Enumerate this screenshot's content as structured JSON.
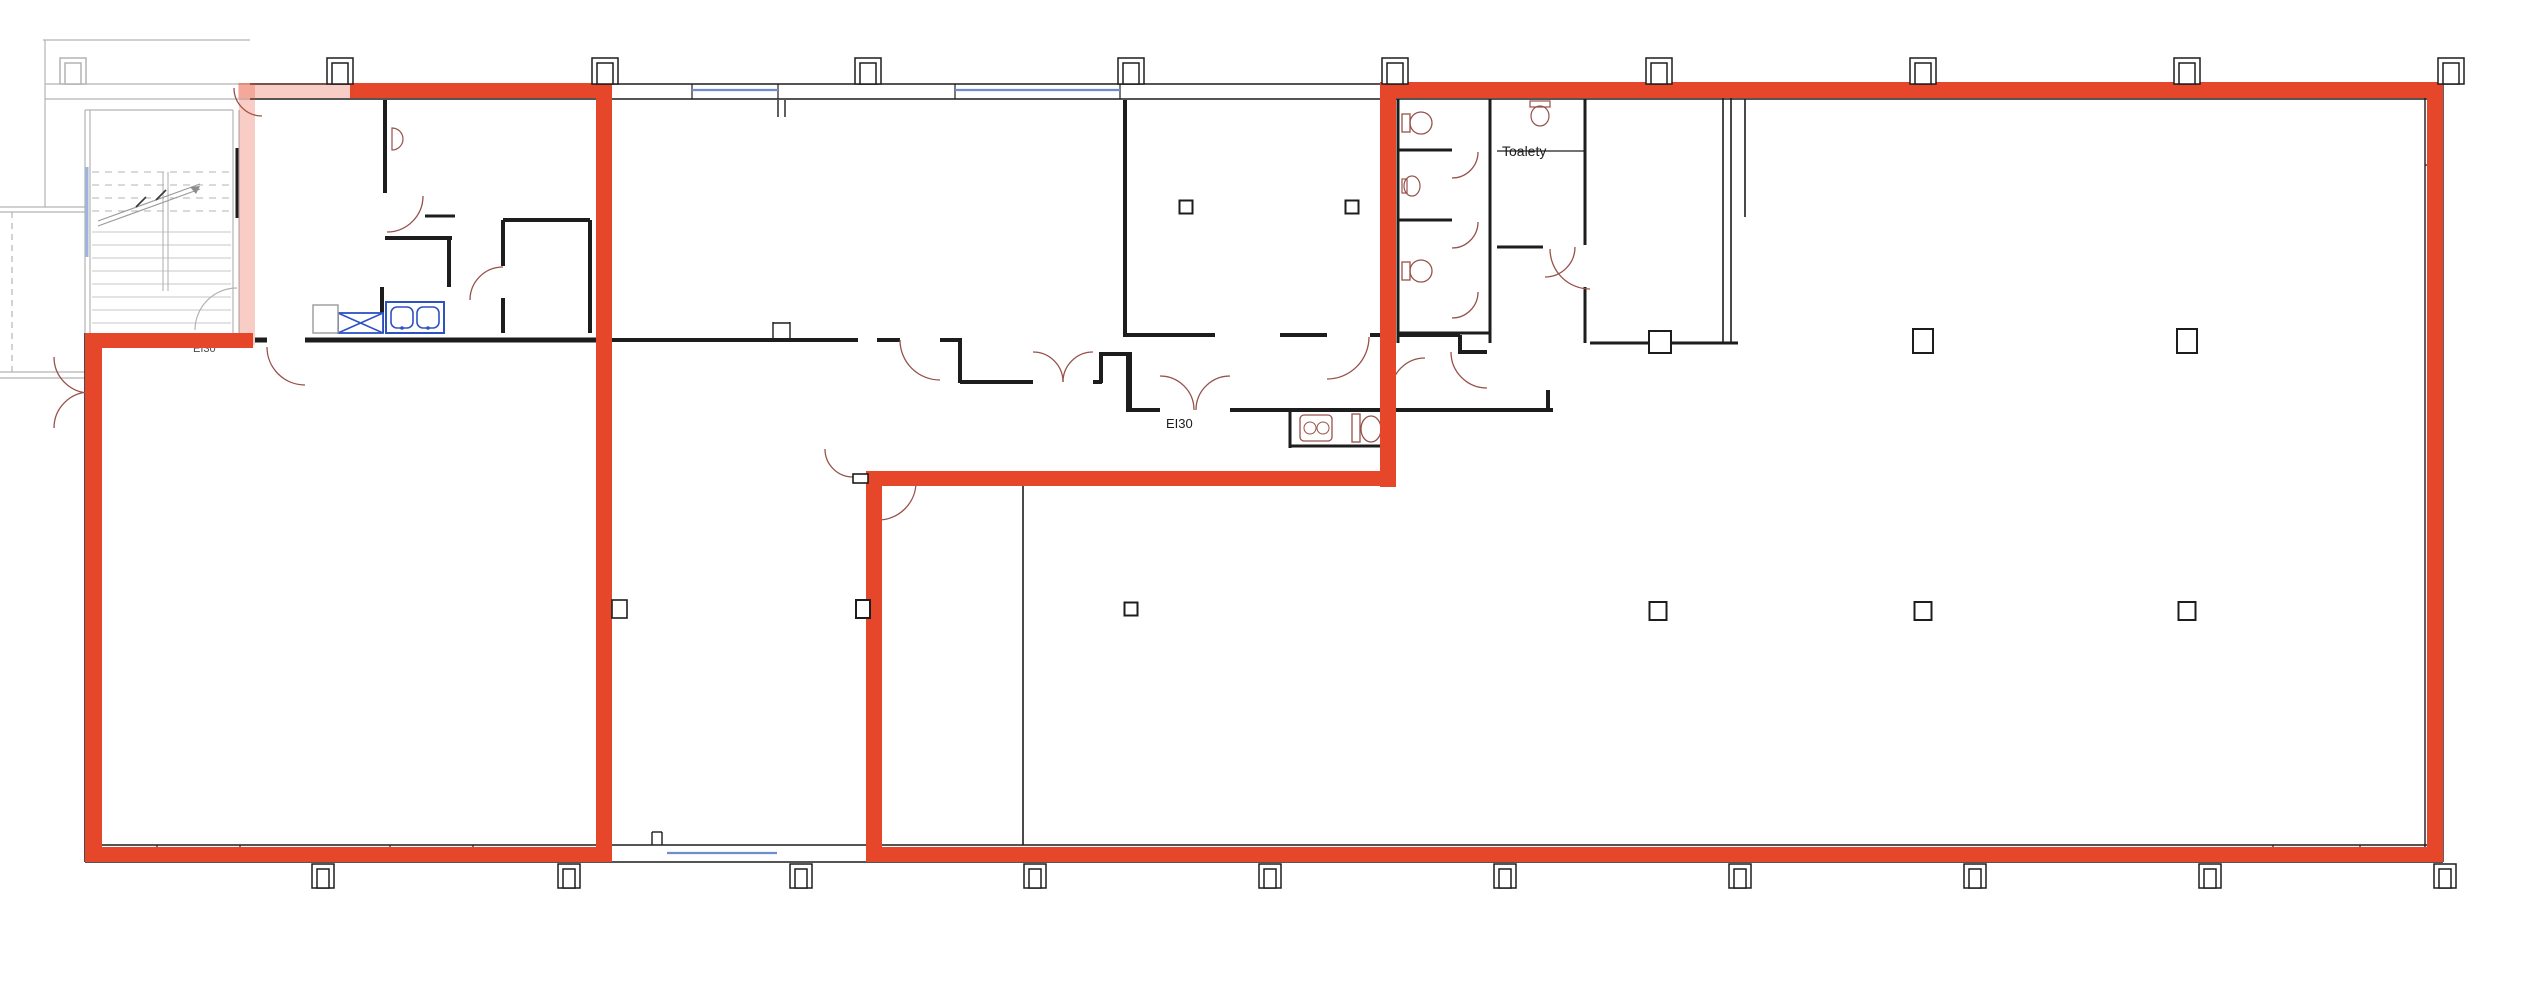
{
  "meta": {
    "title": "Building floor plan with highlighted lease areas",
    "canvas": {
      "width": 2541,
      "height": 994
    },
    "colors": {
      "background": "#ffffff",
      "wall_black": "#1d1d1d",
      "plan_gray": "#b3b3b3",
      "highlight_red": "#e64629",
      "highlight_red_faded": "rgba(230,70,41,0.27)",
      "door_arc_brown": "#96524a",
      "fixture_blue": "#2f52c3",
      "window_light_blue": "#9db4e0",
      "label_dark": "#2e2e2e"
    }
  },
  "labels": [
    {
      "id": "ei30-left-label",
      "text": "EI30",
      "x": 193,
      "y": 352,
      "size": 11,
      "color": "#4a4a4a",
      "under_red": true
    },
    {
      "id": "ei30-middle-label",
      "text": "EI30",
      "x": 1166,
      "y": 428,
      "size": 13,
      "color": "#1d1d1d",
      "under_red": false
    },
    {
      "id": "toalety-label",
      "text": "Toalety",
      "x": 1502,
      "y": 156,
      "size": 14,
      "color": "#1d1d1d",
      "under_red": false
    }
  ],
  "red_outline": {
    "solid": [
      [
        350,
        83,
        262,
        15
      ],
      [
        596,
        83,
        16,
        779
      ],
      [
        85,
        847,
        527,
        15
      ],
      [
        85,
        333,
        17,
        529
      ],
      [
        85,
        333,
        168,
        15
      ],
      [
        1380,
        82,
        1063,
        16
      ],
      [
        1380,
        82,
        16,
        405
      ],
      [
        866,
        471,
        530,
        15
      ],
      [
        866,
        471,
        16,
        391
      ],
      [
        866,
        847,
        1577,
        15
      ],
      [
        2427,
        82,
        16,
        780
      ]
    ],
    "faded": [
      [
        238,
        83,
        116,
        15
      ],
      [
        239,
        83,
        16,
        262
      ]
    ]
  },
  "walls_black": [
    [
      250,
      84,
      2443,
      84,
      1.4
    ],
    [
      250,
      99,
      2443,
      99,
      1.4
    ],
    [
      2425,
      84,
      2425,
      862,
      1.4
    ],
    [
      2443,
      84,
      2443,
      862,
      1.4
    ],
    [
      85,
      845,
      2443,
      845,
      1.4
    ],
    [
      85,
      862,
      2443,
      862,
      1.4
    ],
    [
      85,
      333,
      85,
      862,
      1.6
    ],
    [
      612,
      340,
      858,
      340,
      4
    ],
    [
      877,
      340,
      900,
      340,
      4
    ],
    [
      940,
      340,
      962,
      340,
      4
    ],
    [
      960,
      342,
      960,
      383,
      4
    ],
    [
      960,
      382,
      1033,
      382,
      4
    ],
    [
      1093,
      382,
      1102,
      382,
      4
    ],
    [
      1101,
      352,
      1101,
      383,
      4
    ],
    [
      1101,
      354,
      1127,
      354,
      4
    ],
    [
      1129,
      352,
      1129,
      412,
      6
    ],
    [
      1129,
      410,
      1160,
      410,
      4
    ],
    [
      1230,
      410,
      1553,
      410,
      4
    ],
    [
      1125,
      100,
      1125,
      337,
      4
    ],
    [
      1125,
      335,
      1215,
      335,
      4
    ],
    [
      1280,
      335,
      1327,
      335,
      4
    ],
    [
      1370,
      335,
      1394,
      335,
      4
    ],
    [
      1398,
      335,
      1460,
      335,
      4
    ],
    [
      1460,
      335,
      1460,
      354,
      4
    ],
    [
      1460,
      352,
      1487,
      352,
      4
    ],
    [
      1548,
      390,
      1548,
      412,
      4
    ],
    [
      1290,
      412,
      1290,
      448,
      3
    ],
    [
      1290,
      446,
      1392,
      446,
      3
    ],
    [
      1023,
      486,
      1023,
      845,
      1.6
    ],
    [
      503,
      220,
      503,
      266,
      4
    ],
    [
      503,
      298,
      503,
      333,
      4
    ],
    [
      503,
      220,
      590,
      220,
      4
    ],
    [
      590,
      220,
      590,
      333,
      4
    ],
    [
      305,
      340,
      612,
      340,
      5
    ],
    [
      255,
      340,
      267,
      340,
      5
    ],
    [
      385,
      238,
      452,
      238,
      4
    ],
    [
      449,
      240,
      449,
      287,
      4
    ],
    [
      382,
      287,
      382,
      333,
      4
    ],
    [
      425,
      216,
      455,
      216,
      3
    ],
    [
      385,
      100,
      385,
      193,
      4
    ],
    [
      778,
      100,
      778,
      117,
      1.4
    ],
    [
      785,
      100,
      785,
      117,
      1.4
    ],
    [
      1398,
      99,
      1398,
      343,
      3
    ],
    [
      1490,
      99,
      1490,
      343,
      3
    ],
    [
      1398,
      150,
      1452,
      150,
      3
    ],
    [
      1398,
      220,
      1452,
      220,
      3
    ],
    [
      1398,
      333,
      1490,
      333,
      3
    ],
    [
      1497,
      151,
      1585,
      151,
      1.2
    ],
    [
      1497,
      247,
      1543,
      247,
      3
    ],
    [
      1585,
      99,
      1585,
      245,
      3
    ],
    [
      1585,
      287,
      1585,
      343,
      3
    ],
    [
      1590,
      343,
      1649,
      343,
      3
    ],
    [
      1671,
      343,
      1738,
      343,
      3
    ],
    [
      1723,
      95,
      1723,
      343,
      1.6
    ],
    [
      1731,
      95,
      1731,
      343,
      1.6
    ],
    [
      1745,
      99,
      1745,
      217,
      1.6
    ],
    [
      237,
      148,
      237,
      218,
      3
    ],
    [
      2425,
      165,
      2443,
      165,
      1.2
    ],
    [
      157,
      845,
      157,
      862,
      1.2
    ],
    [
      240,
      845,
      240,
      862,
      1.2
    ],
    [
      390,
      845,
      390,
      862,
      1.2
    ],
    [
      473,
      845,
      473,
      862,
      1.2
    ],
    [
      2273,
      845,
      2273,
      862,
      1.2
    ],
    [
      2360,
      845,
      2360,
      862,
      1.2
    ],
    [
      692,
      84,
      692,
      99,
      1.2
    ],
    [
      778,
      84,
      778,
      99,
      1.2
    ],
    [
      955,
      84,
      955,
      99,
      1.2
    ],
    [
      1120,
      84,
      1120,
      99,
      1.2
    ],
    [
      773,
      322,
      773,
      338,
      1.4
    ],
    [
      790,
      322,
      790,
      338,
      1.4
    ],
    [
      773,
      323,
      790,
      323,
      1.4
    ],
    [
      652,
      832,
      652,
      845,
      1.4
    ],
    [
      662,
      832,
      662,
      845,
      1.4
    ],
    [
      652,
      832,
      662,
      832,
      1.4
    ]
  ],
  "walls_gray": [
    [
      45,
      40,
      45,
      207,
      1.2
    ],
    [
      43,
      40,
      250,
      40,
      1.2
    ],
    [
      45,
      84,
      255,
      84,
      1.2
    ],
    [
      45,
      99,
      255,
      99,
      1.2
    ],
    [
      85,
      110,
      233,
      110,
      1.2
    ],
    [
      85,
      110,
      85,
      333,
      1.2
    ],
    [
      90,
      110,
      90,
      333,
      1.2
    ],
    [
      233,
      110,
      233,
      333,
      1.2
    ],
    [
      239,
      110,
      239,
      333,
      1.2
    ],
    [
      0,
      207,
      85,
      207,
      1.2
    ],
    [
      0,
      212,
      85,
      212,
      1.2
    ],
    [
      0,
      372,
      85,
      372,
      1.2
    ],
    [
      0,
      378,
      85,
      378,
      1.2
    ]
  ],
  "walls_gray_dashed": [
    [
      12,
      212,
      12,
      372,
      1.2
    ]
  ],
  "windows_blue": [
    [
      692,
      90,
      778,
      90
    ],
    [
      955,
      90,
      1120,
      90
    ],
    [
      667,
      853,
      777,
      853
    ]
  ],
  "window_light": [
    87,
    167,
    87,
    257
  ],
  "stairs": {
    "x1": 92,
    "x2": 231,
    "mid1": 163,
    "mid2": 168,
    "dashed_rows_y": [
      172,
      185,
      198,
      211
    ],
    "solid_rows_y": [
      232,
      245,
      258,
      271,
      284,
      297,
      310,
      323
    ],
    "stringer": [
      [
        163,
        172,
        163,
        291
      ],
      [
        168,
        172,
        168,
        291
      ]
    ],
    "diagonal": [
      [
        98,
        226,
        200,
        189
      ],
      [
        98,
        221,
        200,
        184
      ]
    ],
    "cut_marks": [
      [
        136,
        207,
        146,
        197
      ],
      [
        156,
        200,
        166,
        190
      ]
    ],
    "arrow_tip": [
      200,
      186
    ]
  },
  "arcs_brown": [
    {
      "c": [
        262,
        88
      ],
      "r": 28,
      "from": 90,
      "to": 180
    },
    {
      "c": [
        387,
        196
      ],
      "r": 36,
      "from": 0,
      "to": 90
    },
    {
      "c": [
        503,
        300
      ],
      "r": 33,
      "from": 180,
      "to": 270
    },
    {
      "c": [
        305,
        347
      ],
      "r": 38,
      "from": 90,
      "to": 180
    },
    {
      "c": [
        90,
        357
      ],
      "r": 36,
      "from": 90,
      "to": 180
    },
    {
      "c": [
        90,
        428
      ],
      "r": 36,
      "from": 180,
      "to": 270
    },
    {
      "c": [
        940,
        340
      ],
      "r": 40,
      "from": 90,
      "to": 180
    },
    {
      "c": [
        1033,
        382
      ],
      "r": 30,
      "from": 270,
      "to": 360
    },
    {
      "c": [
        1093,
        382
      ],
      "r": 30,
      "from": 180,
      "to": 270
    },
    {
      "c": [
        1327,
        337
      ],
      "r": 42,
      "from": 0,
      "to": 90
    },
    {
      "c": [
        1160,
        410
      ],
      "r": 34,
      "from": 270,
      "to": 360
    },
    {
      "c": [
        1230,
        410
      ],
      "r": 34,
      "from": 180,
      "to": 270
    },
    {
      "c": [
        1487,
        352
      ],
      "r": 36,
      "from": 90,
      "to": 180
    },
    {
      "c": [
        853,
        449
      ],
      "r": 28,
      "from": 90,
      "to": 180
    },
    {
      "c": [
        878,
        482
      ],
      "r": 38,
      "from": 0,
      "to": 90
    },
    {
      "c": [
        1590,
        249
      ],
      "r": 40,
      "from": 90,
      "to": 180
    },
    {
      "c": [
        1452,
        152
      ],
      "r": 26,
      "from": 0,
      "to": 90
    },
    {
      "c": [
        1452,
        222
      ],
      "r": 26,
      "from": 0,
      "to": 90
    },
    {
      "c": [
        1452,
        292
      ],
      "r": 26,
      "from": 0,
      "to": 90
    },
    {
      "c": [
        1425,
        392
      ],
      "r": 34,
      "from": 180,
      "to": 270
    },
    {
      "c": [
        1545,
        247
      ],
      "r": 30,
      "from": 0,
      "to": 90
    }
  ],
  "arcs_gray": [
    {
      "c": [
        237,
        330
      ],
      "r": 42,
      "from": 180,
      "to": 270
    }
  ],
  "columns_top": {
    "centers_x": [
      73,
      340,
      605,
      868,
      1131,
      1395,
      1659,
      1923,
      2187,
      2451
    ],
    "y": 58,
    "w": 26,
    "h": 26,
    "gray_idx": [
      0
    ]
  },
  "columns_bottom": {
    "centers_x": [
      323,
      569,
      801,
      1035,
      1270,
      1505,
      1740,
      1975,
      2210,
      2445
    ],
    "y": 864,
    "w": 22,
    "h": 24,
    "gray_idx": []
  },
  "columns_free": [
    {
      "x": 1186,
      "y": 207,
      "w": 13,
      "h": 13
    },
    {
      "x": 1352,
      "y": 207,
      "w": 13,
      "h": 13
    },
    {
      "x": 1660,
      "y": 342,
      "w": 22,
      "h": 22
    },
    {
      "x": 1923,
      "y": 341,
      "w": 20,
      "h": 24
    },
    {
      "x": 2187,
      "y": 341,
      "w": 20,
      "h": 24
    },
    {
      "x": 863,
      "y": 609,
      "w": 14,
      "h": 18
    },
    {
      "x": 1131,
      "y": 609,
      "w": 13,
      "h": 13
    },
    {
      "x": 1658,
      "y": 611,
      "w": 17,
      "h": 18
    },
    {
      "x": 1923,
      "y": 611,
      "w": 17,
      "h": 18
    },
    {
      "x": 2187,
      "y": 611,
      "w": 17,
      "h": 18
    }
  ],
  "door_jambs_over_red": [
    [
      612,
      600,
      15,
      18
    ],
    [
      853,
      474,
      15,
      9
    ]
  ],
  "fixtures": {
    "toilets_d": [
      {
        "type": "wc",
        "x": 1402,
        "y": 112
      },
      {
        "type": "basin",
        "x": 1402,
        "y": 176
      },
      {
        "type": "wc",
        "x": 1402,
        "y": 260
      }
    ],
    "urinal": {
      "x": 1530,
      "y": 101
    },
    "radiator_d": {
      "x": 392,
      "y": 128
    },
    "wcroom_basin": {
      "x": 1300,
      "y": 415,
      "w": 32,
      "h": 26
    },
    "wcroom_wc": {
      "x": 1352,
      "y": 414
    },
    "kitchen_sink": {
      "x": 386,
      "y": 302,
      "w": 58,
      "h": 31
    },
    "x_cabinet": {
      "x": 338,
      "y": 313,
      "w": 45,
      "h": 20
    },
    "white_cabinet": {
      "x": 313,
      "y": 305,
      "w": 25,
      "h": 28
    }
  }
}
